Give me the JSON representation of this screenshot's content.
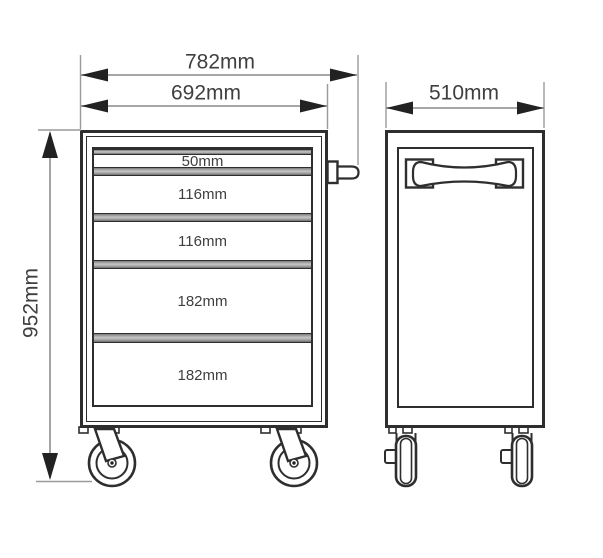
{
  "front_view": {
    "overall_width_label": "782mm",
    "body_width_label": "692mm",
    "overall_height_label": "952mm",
    "drawers": [
      {
        "label": "50mm"
      },
      {
        "label": "116mm"
      },
      {
        "label": "116mm"
      },
      {
        "label": "182mm"
      },
      {
        "label": "182mm"
      }
    ]
  },
  "side_view": {
    "depth_label": "510mm"
  },
  "colors": {
    "object_line": "#2e2e2e",
    "dimension_line": "#9a9a9a",
    "arrow": "#222222",
    "text": "#3f3f3f",
    "rail_fill": "#a8a8a8",
    "background": "#ffffff"
  }
}
